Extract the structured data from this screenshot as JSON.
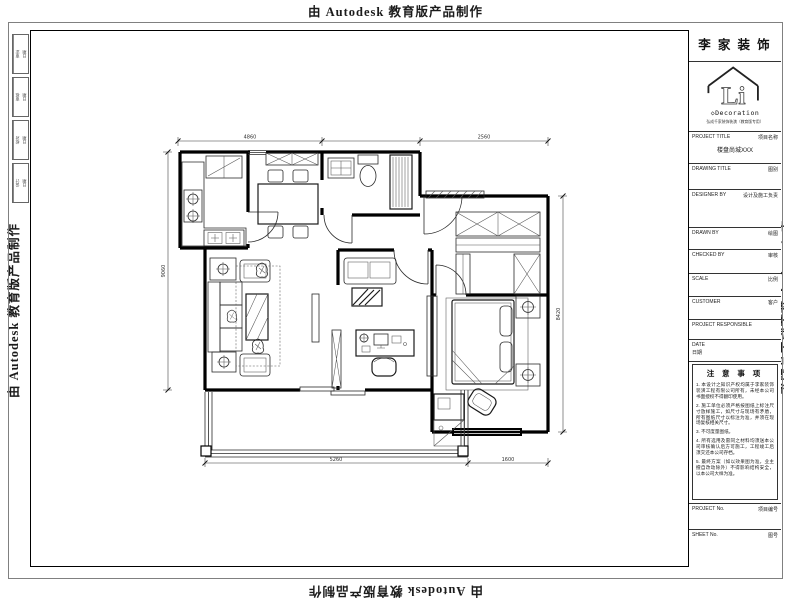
{
  "watermark": {
    "text": "由 Autodesk 教育版产品制作"
  },
  "revision_strip": {
    "rows": [
      [
        "审定",
        "日期"
      ],
      [
        "审核",
        "日期"
      ],
      [
        "校对",
        "日期"
      ],
      [
        "设计",
        "日期"
      ]
    ]
  },
  "title_block": {
    "company_name": "李 家 装 饰",
    "logo_text": "Li",
    "logo_subtitle": "◇Decoration",
    "tagline": "弘成千家装饰装潢（教育版专用）",
    "project_title": {
      "label_en": "PROJECT TITLE",
      "label_cn": "项目名称",
      "value": "楼盘尚城XXX"
    },
    "drawing_title": {
      "label_en": "DRAWING TITLE",
      "label_cn": "图别"
    },
    "designer_by": {
      "label_en": "DESIGNER BY",
      "label_cn": "设计及施工负责"
    },
    "drawn_by": {
      "label_en": "DRAWN BY",
      "label_cn": "绘图"
    },
    "checked_by": {
      "label_en": "CHECKED BY",
      "label_cn": "审核"
    },
    "scale": {
      "label_en": "SCALE",
      "label_cn": "比例"
    },
    "customer": {
      "label_en": "CUSTOMER",
      "label_cn": "客户"
    },
    "project_responsible": {
      "label_en": "PROJECT RESPONSIBLE",
      "label_cn": ""
    },
    "date": {
      "label_en": "DATE",
      "label_cn": "日期"
    },
    "notes": {
      "title": "注 意 事 项",
      "items": [
        "1. 本设计之知识产权均属于李家装饰装潢工程有限公司所有，未经本公司书面授权不得翻印使用。",
        "2. 施工单位必须严格按图纸上标注尺寸放样施工，如尺寸与现场有矛盾，所有图纸尺寸以标注为准，并须在现场复核相关尺寸。",
        "3. 不可度量图纸。",
        "4. 所有选用及雷同之材料均须送本公司审核确认后方可施工，工程竣工后须交还本公司存档。",
        "5. 最终方案（如以效果图为准，业主擅自改动除外）不得影响结构安全，以本公司大样为准。"
      ]
    },
    "project_no": {
      "label_en": "PROJECT No.",
      "label_cn": "项目编号"
    },
    "sheet_no": {
      "label_en": "SHEET No.",
      "label_cn": "图号"
    }
  },
  "floor_plan": {
    "dimensions": {
      "top_left": "4860",
      "top_right": "2560",
      "bottom_left": "5260",
      "bottom_right": "1600",
      "right_side": "8420",
      "left_side": "9060"
    }
  }
}
